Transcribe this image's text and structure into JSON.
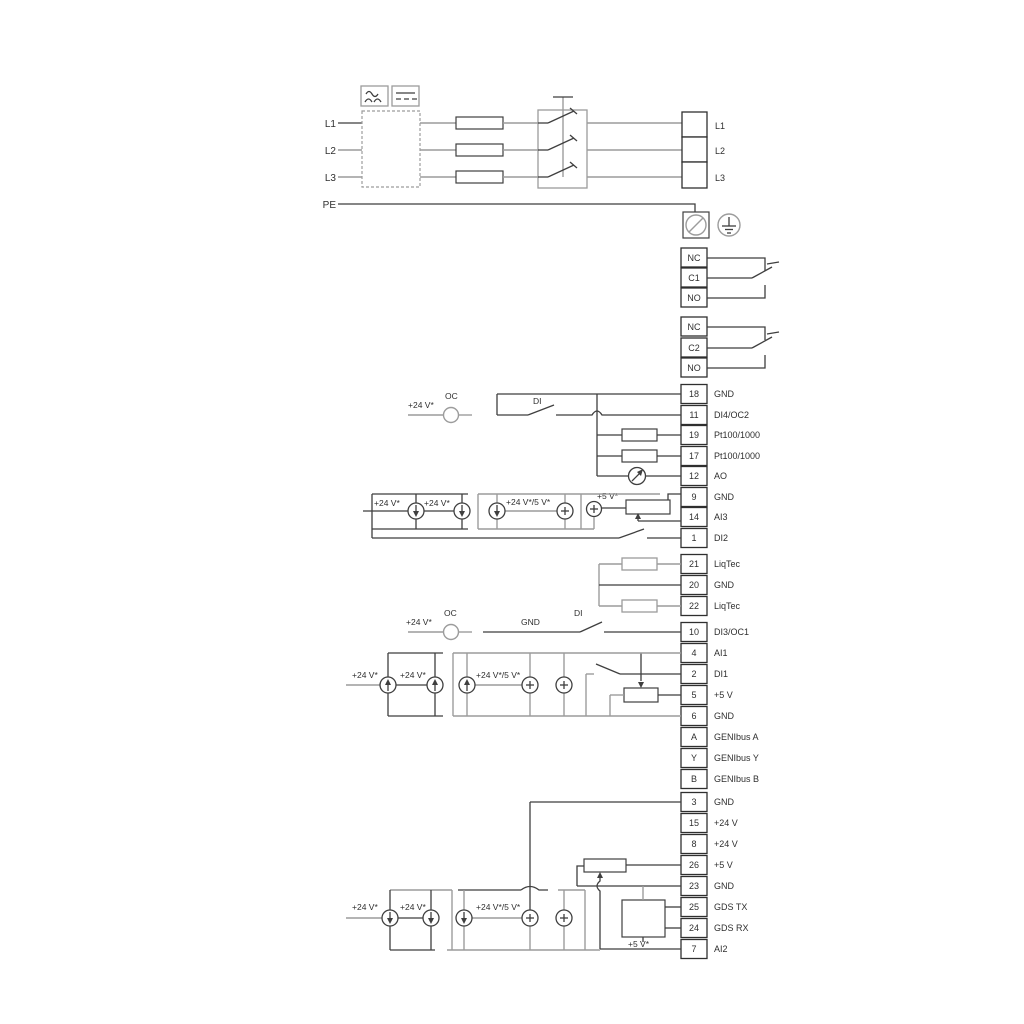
{
  "colors": {
    "wire_dark": "#3f3f3f",
    "wire_gray": "#9c9c9c",
    "text": "#2f2f2f",
    "background": "#ffffff"
  },
  "power": {
    "inputs": [
      "L1",
      "L2",
      "L3",
      "PE"
    ],
    "outputs": [
      "L1",
      "L2",
      "L3"
    ]
  },
  "relays": {
    "r1": {
      "nc": "NC",
      "c": "C1",
      "no": "NO"
    },
    "r2": {
      "nc": "NC",
      "c": "C2",
      "no": "NO"
    }
  },
  "io1": [
    {
      "n": "18",
      "t": "GND"
    },
    {
      "n": "11",
      "t": "DI4/OC2"
    },
    {
      "n": "19",
      "t": "Pt100/1000"
    },
    {
      "n": "17",
      "t": "Pt100/1000"
    },
    {
      "n": "12",
      "t": "AO"
    },
    {
      "n": "9",
      "t": "GND"
    },
    {
      "n": "14",
      "t": "AI3"
    },
    {
      "n": "1",
      "t": "DI2"
    }
  ],
  "liqtec": [
    {
      "n": "21",
      "t": "LiqTec"
    },
    {
      "n": "20",
      "t": "GND"
    },
    {
      "n": "22",
      "t": "LiqTec"
    }
  ],
  "io2": [
    {
      "n": "10",
      "t": "DI3/OC1"
    },
    {
      "n": "4",
      "t": "AI1"
    },
    {
      "n": "2",
      "t": "DI1"
    },
    {
      "n": "5",
      "t": "+5 V"
    },
    {
      "n": "6",
      "t": "GND"
    },
    {
      "n": "A",
      "t": "GENIbus A"
    },
    {
      "n": "Y",
      "t": "GENIbus Y"
    },
    {
      "n": "B",
      "t": "GENIbus B"
    }
  ],
  "io3": [
    {
      "n": "3",
      "t": "GND"
    },
    {
      "n": "15",
      "t": "+24 V"
    },
    {
      "n": "8",
      "t": "+24 V"
    },
    {
      "n": "26",
      "t": "+5 V"
    },
    {
      "n": "23",
      "t": "GND"
    },
    {
      "n": "25",
      "t": "GDS TX"
    },
    {
      "n": "24",
      "t": "GDS RX"
    },
    {
      "n": "7",
      "t": "AI2"
    }
  ],
  "lbl": {
    "p24": "+24 V*",
    "p24or5": "+24 V*/5 V*",
    "p5": "+5 V*",
    "oc": "OC",
    "di": "DI",
    "gnd": "GND"
  }
}
